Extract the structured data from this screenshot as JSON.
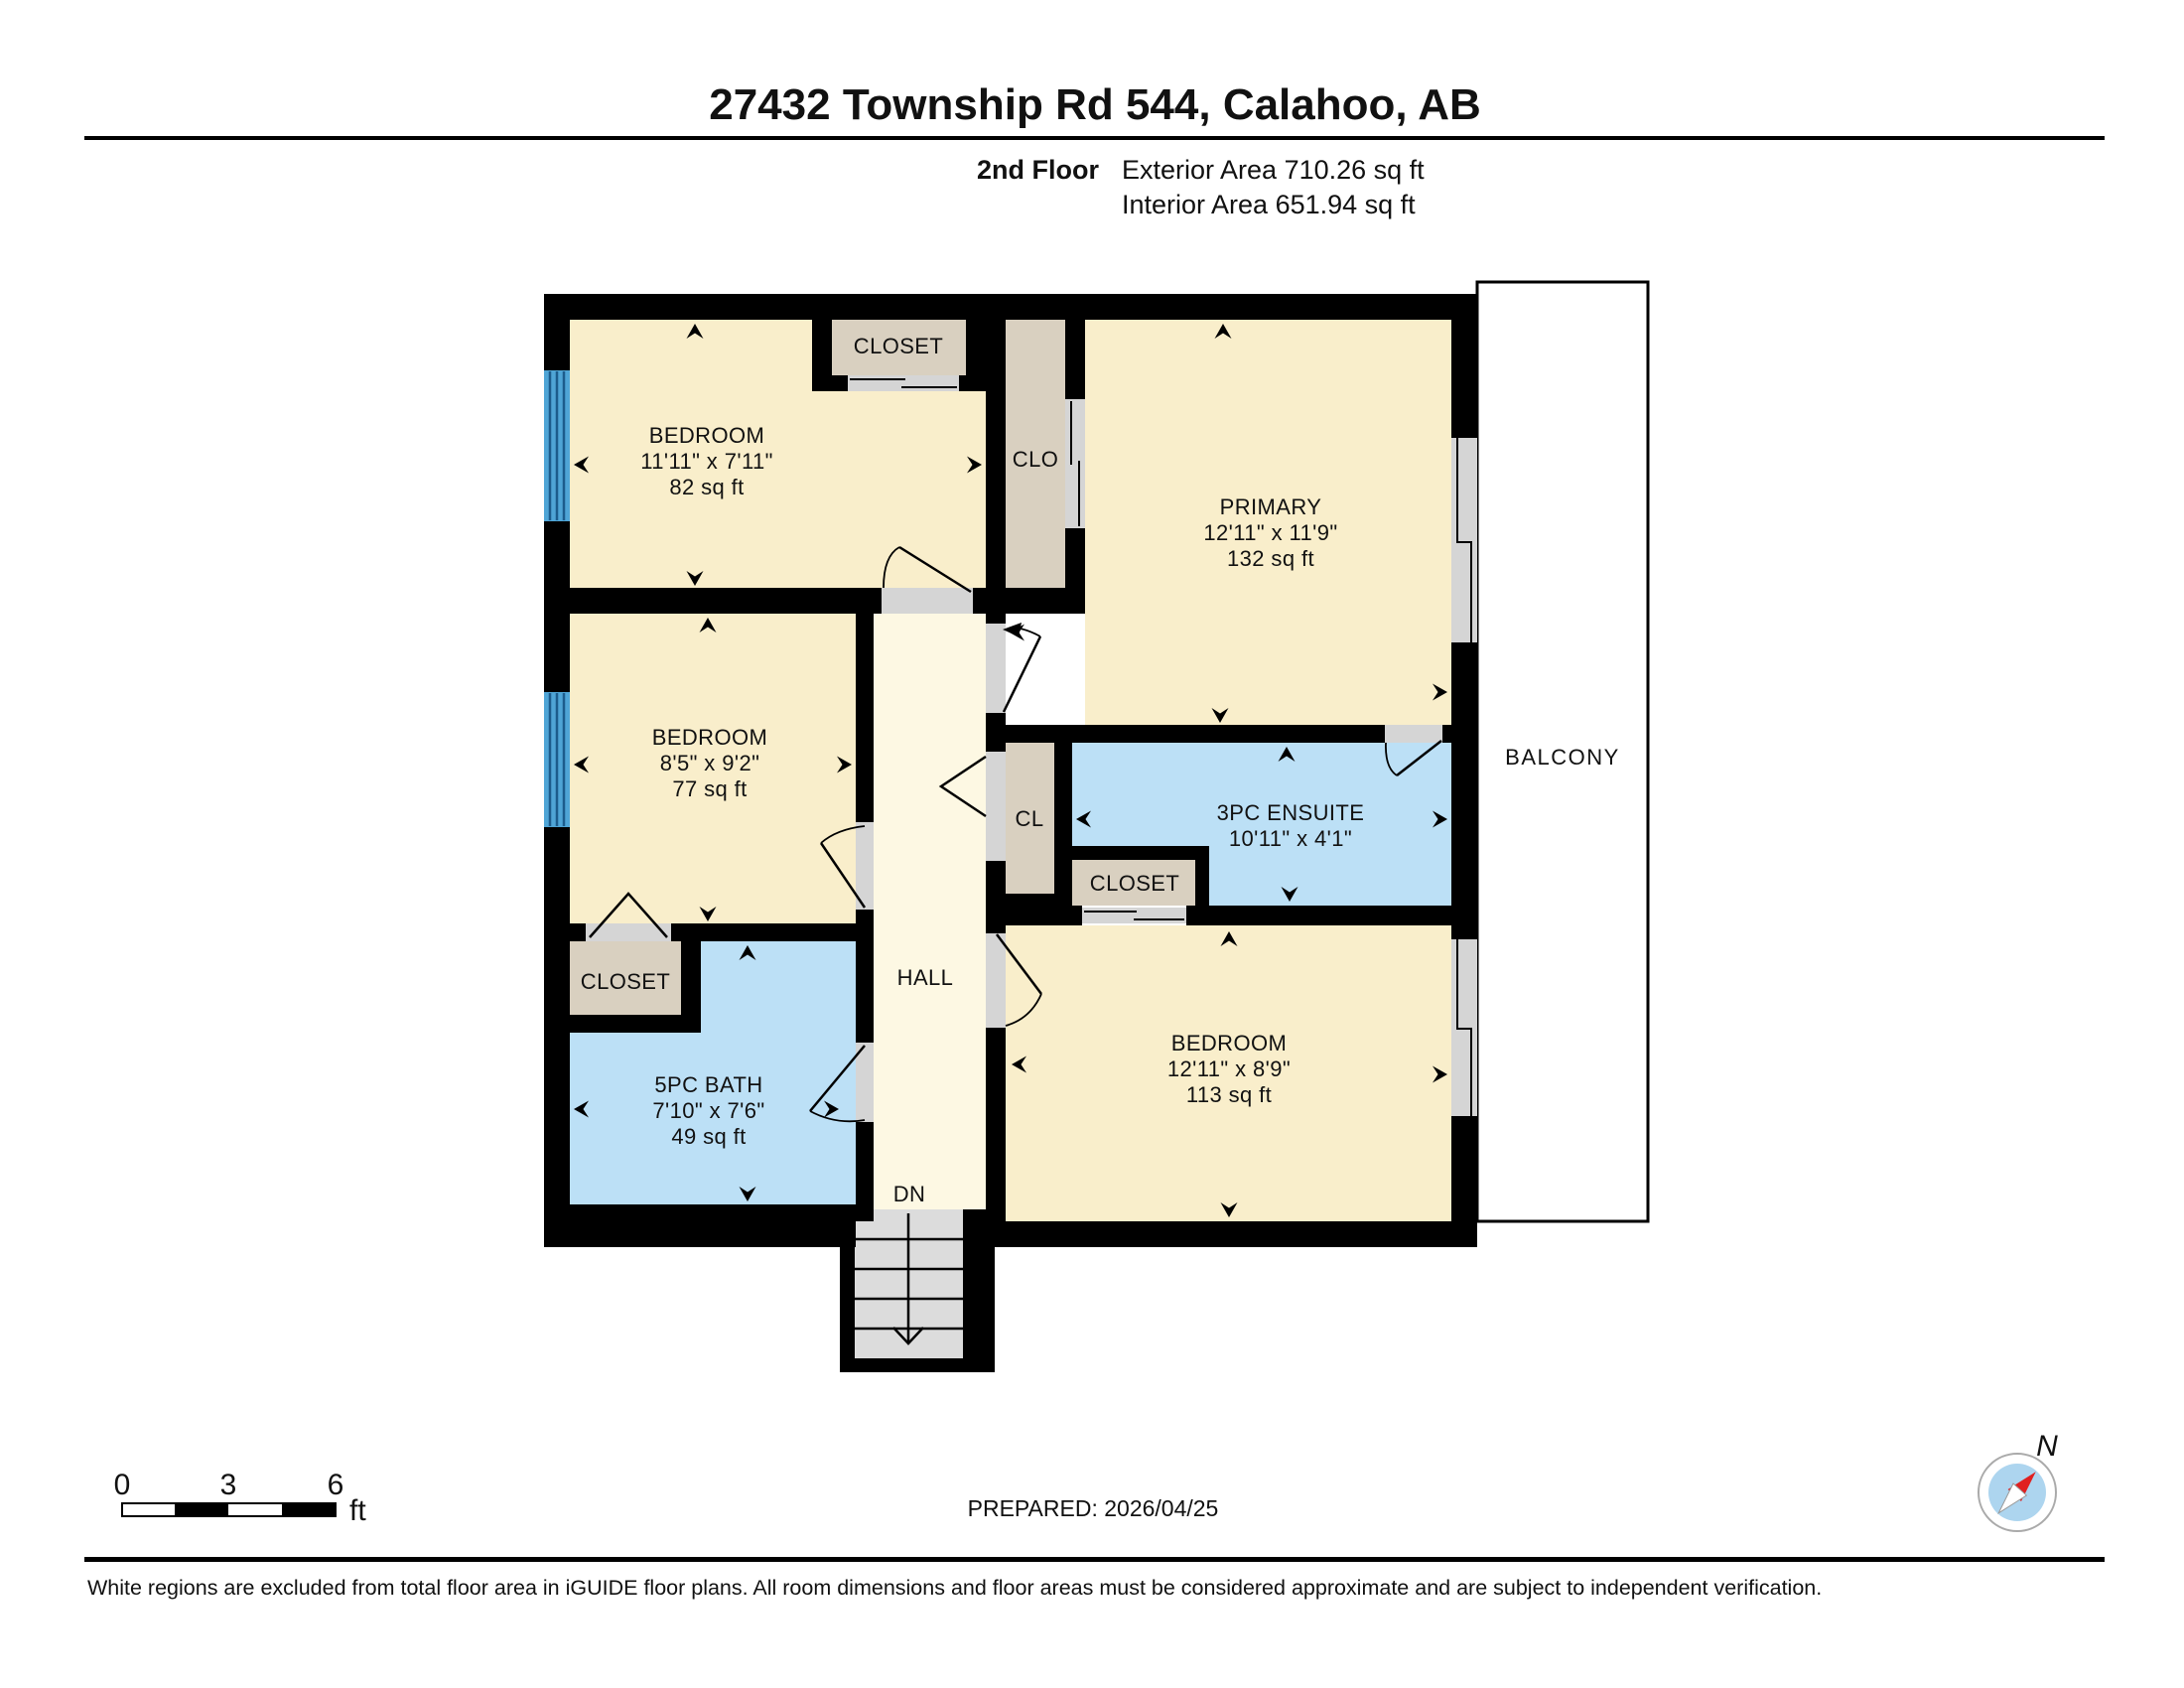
{
  "colors": {
    "room": "#F9EECB",
    "hall": "#FDF8E3",
    "wet": "#BCE0F6",
    "closet": "#D9D0C0",
    "stairs": "#DCDCDC",
    "jamb": "#D5D5D5",
    "window": "#4FA5D6",
    "windowline": "#1C5C8C",
    "wall": "#000000",
    "compass_disc": "#ADD5EF",
    "compass_needle": "#E02020"
  },
  "header": {
    "title": "27432 Township Rd 544, Calahoo, AB",
    "floor_label": "2nd Floor",
    "exterior_area": "Exterior Area 710.26 sq ft",
    "interior_area": "Interior Area 651.94 sq ft"
  },
  "rooms": {
    "bedroom_tl": {
      "name": "BEDROOM",
      "dims": "11'11\" x 7'11\"",
      "area": "82 sq ft"
    },
    "bedroom_ml": {
      "name": "BEDROOM",
      "dims": "8'5\" x 9'2\"",
      "area": "77 sq ft"
    },
    "primary": {
      "name": "PRIMARY",
      "dims": "12'11\" x 11'9\"",
      "area": "132 sq ft"
    },
    "ensuite": {
      "name": "3PC ENSUITE",
      "dims": "10'11\" x 4'1\""
    },
    "bath": {
      "name": "5PC BATH",
      "dims": "7'10\" x 7'6\"",
      "area": "49 sq ft"
    },
    "bedroom_br": {
      "name": "BEDROOM",
      "dims": "12'11\" x 8'9\"",
      "area": "113 sq ft"
    },
    "hall": {
      "name": "HALL"
    },
    "balcony": {
      "name": "BALCONY"
    }
  },
  "labels": {
    "closet": "CLOSET",
    "clo": "CLO",
    "cl": "CL",
    "dn": "DN"
  },
  "scalebar": {
    "tick0": "0",
    "tick1": "3",
    "tick2": "6",
    "unit": "ft"
  },
  "compass": {
    "north": "N"
  },
  "footer": {
    "prepared": "PREPARED: 2026/04/25",
    "disclaimer": "White regions are excluded from total floor area in iGUIDE floor plans. All room dimensions and floor areas must be considered approximate and are subject to independent verification."
  }
}
